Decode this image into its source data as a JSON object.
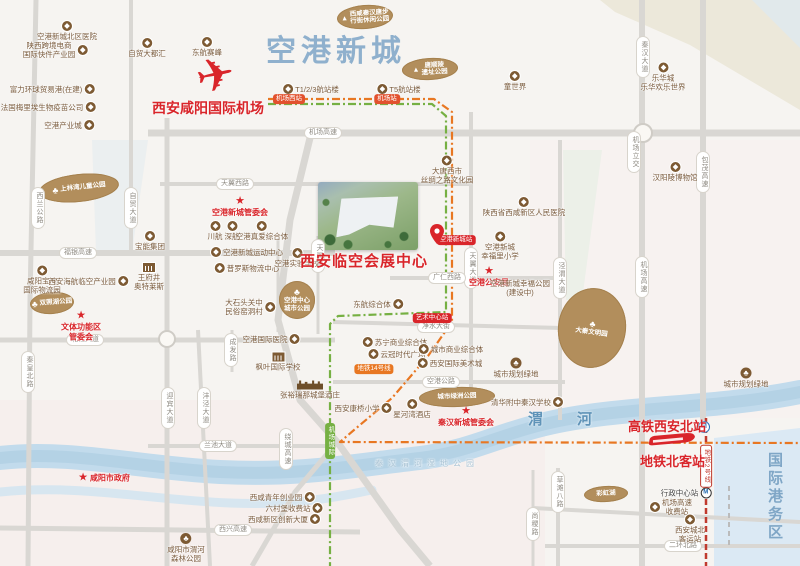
{
  "major": {
    "district": "空港新城",
    "airport": "西安咸阳国际机场",
    "venue": "西安临空会展中心",
    "hsr_station": "高铁西安北站",
    "metro_station": "地铁北客站",
    "river_name": "渭河",
    "port_zone": "国际港务区"
  },
  "colors": {
    "accent_red": "#d9252a",
    "poi_brown": "#7d5a33",
    "blob_brown": "#b28e5c",
    "title_blue": "#8fb0cd",
    "river_blue": "#c2dbec",
    "rail_green": "#76b043",
    "rail_orange": "#e87722",
    "metro_red": "#c03a2e",
    "road_gray": "#d9d7d3"
  },
  "zones": [
    {
      "pts": "600,0 800,0 800,110 690,45 615,12",
      "f": "#ece8da",
      "o": 1
    },
    {
      "pts": "752,0 800,0 800,48",
      "f": "#dde9f2",
      "o": 0.7
    },
    {
      "pts": "530,140 800,140 800,418 530,418",
      "f": "#f8f0ee",
      "o": 0.55
    },
    {
      "pts": "0,400 545,400 545,566 0,566",
      "f": "#f6e9e9",
      "o": 0.5
    },
    {
      "pts": "92,140 148,140 132,252 96,252",
      "f": "#e8eef0",
      "o": 0.8
    },
    {
      "pts": "563,150 602,150 582,300 566,300",
      "f": "#e8efe6",
      "o": 0.8
    },
    {
      "pts": "714,438 800,428 800,566 714,566",
      "f": "#dbe9f4",
      "o": 1
    }
  ],
  "river": [
    {
      "d": "M0,458 C70,450 140,468 220,472 S350,466 420,458 C470,452 495,436 545,424 C620,406 710,410 800,392",
      "c": "#c2dbec",
      "w": 24,
      "o": 1
    },
    {
      "d": "M0,458 C70,450 140,468 220,472 S350,466 420,458 C470,452 495,436 545,424 C620,406 710,410 800,392",
      "c": "#b0d0e4",
      "w": 12,
      "o": 0.8
    },
    {
      "d": "M0,492 C80,484 150,500 230,503 C300,506 340,496 372,490",
      "c": "#cfe3f0",
      "w": 9,
      "o": 0.8
    }
  ],
  "roads": [
    {
      "p": [
        [
          36,
          0
        ],
        [
          30,
          300
        ],
        [
          28,
          566
        ]
      ],
      "w": 5
    },
    {
      "p": [
        [
          131,
          0
        ],
        [
          131,
          253
        ]
      ],
      "w": 4
    },
    {
      "p": [
        [
          167,
          118
        ],
        [
          167,
          566
        ]
      ],
      "w": 5
    },
    {
      "p": [
        [
          198,
          330
        ],
        [
          210,
          566
        ]
      ],
      "w": 4
    },
    {
      "p": [
        [
          232,
          330
        ],
        [
          232,
          372
        ]
      ],
      "w": 3
    },
    {
      "p": [
        [
          278,
          238
        ],
        [
          278,
          332
        ]
      ],
      "w": 3
    },
    {
      "p": [
        [
          318,
          236
        ],
        [
          318,
          334
        ]
      ],
      "w": 3
    },
    {
      "p": [
        [
          471,
          112
        ],
        [
          471,
          390
        ]
      ],
      "w": 4
    },
    {
      "p": [
        [
          560,
          140
        ],
        [
          560,
          420
        ]
      ],
      "w": 4
    },
    {
      "p": [
        [
          558,
          468
        ],
        [
          558,
          566
        ]
      ],
      "w": 4
    },
    {
      "p": [
        [
          642,
          0
        ],
        [
          642,
          566
        ]
      ],
      "w": 6
    },
    {
      "p": [
        [
          703,
          0
        ],
        [
          703,
          425
        ]
      ],
      "w": 6
    },
    {
      "p": [
        [
          533,
          470
        ],
        [
          533,
          566
        ]
      ],
      "w": 3
    },
    {
      "p": [
        [
          148,
          133
        ],
        [
          800,
          133
        ]
      ],
      "w": 7
    },
    {
      "p": [
        [
          160,
          184
        ],
        [
          471,
          184
        ]
      ],
      "w": 4
    },
    {
      "p": [
        [
          0,
          253
        ],
        [
          335,
          253
        ]
      ],
      "w": 6
    },
    {
      "p": [
        [
          390,
          278
        ],
        [
          562,
          278
        ]
      ],
      "w": 4
    },
    {
      "p": [
        [
          333,
          322
        ],
        [
          562,
          328
        ]
      ],
      "w": 4
    },
    {
      "p": [
        [
          0,
          340
        ],
        [
          335,
          340
        ]
      ],
      "w": 5
    },
    {
      "p": [
        [
          333,
          382
        ],
        [
          565,
          382
        ]
      ],
      "w": 4
    },
    {
      "p": [
        [
          148,
          446
        ],
        [
          335,
          446
        ]
      ],
      "w": 4
    },
    {
      "p": [
        [
          0,
          528
        ],
        [
          360,
          532
        ]
      ],
      "w": 5
    },
    {
      "p": [
        [
          545,
          546
        ],
        [
          800,
          546
        ]
      ],
      "w": 4
    },
    {
      "p": [
        [
          533,
          508
        ],
        [
          800,
          522
        ]
      ],
      "w": 4
    },
    {
      "p": [
        [
          310,
          138
        ],
        [
          290,
          220
        ],
        [
          278,
          320
        ],
        [
          300,
          400
        ],
        [
          338,
          443
        ],
        [
          400,
          530
        ],
        [
          430,
          566
        ]
      ],
      "w": 7
    },
    {
      "p": [
        [
          338,
          441
        ],
        [
          295,
          492
        ],
        [
          252,
          566
        ]
      ],
      "w": 5
    }
  ],
  "circles": [
    {
      "x": 167,
      "y": 339,
      "r": 8
    },
    {
      "x": 643,
      "y": 133,
      "r": 9
    }
  ],
  "rails": [
    {
      "p": [
        [
          268,
          104
        ],
        [
          432,
          104
        ],
        [
          446,
          116
        ],
        [
          446,
          312
        ],
        [
          338,
          316
        ],
        [
          330,
          324
        ],
        [
          330,
          566
        ]
      ],
      "c": "#76b043",
      "w": 2.2,
      "d": "8 3 2 3"
    },
    {
      "p": [
        [
          268,
          99
        ],
        [
          434,
          99
        ],
        [
          452,
          112
        ],
        [
          452,
          322
        ],
        [
          428,
          356
        ],
        [
          392,
          398
        ],
        [
          354,
          430
        ],
        [
          340,
          442
        ],
        [
          800,
          443
        ]
      ],
      "c": "#e87722",
      "w": 2.2,
      "d": "8 3 2 3"
    },
    {
      "p": [
        [
          706,
          418
        ],
        [
          706,
          566
        ]
      ],
      "c": "#c03a2e",
      "w": 2.5,
      "d": "6 3"
    },
    {
      "p": [
        [
          729,
          486
        ],
        [
          729,
          546
        ]
      ],
      "c": "#bbbbbb",
      "w": 2,
      "d": "5 4"
    }
  ],
  "blobs": [
    {
      "x": 365,
      "y": 17,
      "rx": 28,
      "ry": 12,
      "rot": -4,
      "kind": "badge",
      "label": "西咸秦汉唐步\n行街休闲公园"
    },
    {
      "x": 430,
      "y": 69,
      "rx": 28,
      "ry": 11,
      "rot": -3,
      "kind": "badge",
      "label": "唐顺陵\n遗址公园"
    },
    {
      "x": 79,
      "y": 188,
      "rx": 40,
      "ry": 14,
      "rot": -6,
      "kind": "tree",
      "label": "上林湾儿童公园"
    },
    {
      "x": 52,
      "y": 303,
      "rx": 22,
      "ry": 11,
      "rot": -4,
      "kind": "tree",
      "label": "双照湖公园"
    },
    {
      "x": 297,
      "y": 300,
      "rx": 18,
      "ry": 19,
      "rot": 0,
      "kind": "treetop",
      "label": "空港中心\n城市公园"
    },
    {
      "x": 592,
      "y": 328,
      "rx": 34,
      "ry": 40,
      "rot": 8,
      "kind": "treetop",
      "label": "大秦文明园"
    },
    {
      "x": 457,
      "y": 397,
      "rx": 38,
      "ry": 10,
      "rot": -2,
      "kind": "plain",
      "label": "城市绿洲公园"
    },
    {
      "x": 606,
      "y": 494,
      "rx": 22,
      "ry": 8,
      "rot": -3,
      "kind": "plain",
      "label": "彩虹湖"
    }
  ],
  "pois": [
    {
      "t": "空港新城北区医院",
      "x": 67,
      "y": 31,
      "i": "c",
      "p": "t"
    },
    {
      "t": "陕西跨境电商\n国际快件产业园",
      "x": 55,
      "y": 50,
      "i": "c",
      "p": "r"
    },
    {
      "t": "自贸大都汇",
      "x": 147,
      "y": 48,
      "i": "c",
      "p": "t"
    },
    {
      "t": "东航赛峰",
      "x": 207,
      "y": 47,
      "i": "c",
      "p": "t"
    },
    {
      "t": "富力环球贸易港(在建)",
      "x": 52,
      "y": 89,
      "i": "c",
      "p": "r"
    },
    {
      "t": "法国梅里埃生物疫苗公司",
      "x": 48,
      "y": 107,
      "i": "c",
      "p": "r"
    },
    {
      "t": "空港产业城",
      "x": 69,
      "y": 125,
      "i": "c",
      "p": "r"
    },
    {
      "t": "T1/2/3航站楼",
      "x": 311,
      "y": 89,
      "i": "c",
      "p": "l"
    },
    {
      "t": "T5航站楼",
      "x": 399,
      "y": 89,
      "i": "c",
      "p": "l"
    },
    {
      "t": "童世界",
      "x": 515,
      "y": 81,
      "i": "c",
      "p": "t"
    },
    {
      "t": "乐华城\n乐华欢乐世界",
      "x": 663,
      "y": 77,
      "i": "c",
      "p": "t"
    },
    {
      "t": "汉阳陵博物馆",
      "x": 675,
      "y": 172,
      "i": "c",
      "p": "t"
    },
    {
      "t": "陕西省西咸新区人民医院",
      "x": 524,
      "y": 207,
      "i": "c",
      "p": "t"
    },
    {
      "t": "大唐西市\n丝绸之路文化园",
      "x": 447,
      "y": 170,
      "i": "c",
      "p": "t"
    },
    {
      "t": "空港新城管委会",
      "x": 240,
      "y": 207,
      "i": "s",
      "p": "t",
      "s": "red"
    },
    {
      "t": "川航",
      "x": 215,
      "y": 231,
      "i": "c",
      "p": "t"
    },
    {
      "t": "深航",
      "x": 232,
      "y": 231,
      "i": "c",
      "p": "t"
    },
    {
      "t": "空港真爱综合体",
      "x": 262,
      "y": 231,
      "i": "c",
      "p": "t"
    },
    {
      "t": "宝能集团",
      "x": 150,
      "y": 241,
      "i": "c",
      "p": "t"
    },
    {
      "t": "空港新城运动中心",
      "x": 247,
      "y": 252,
      "i": "c",
      "p": "l"
    },
    {
      "t": "普罗斯物流中心",
      "x": 247,
      "y": 268,
      "i": "c",
      "p": "l"
    },
    {
      "t": "咸阳宝湾\n国际物流园",
      "x": 42,
      "y": 280,
      "i": "c",
      "p": "t"
    },
    {
      "t": "西安海航临空产业园",
      "x": 88,
      "y": 281,
      "i": "c",
      "p": "r"
    },
    {
      "t": "王府井\n奥特莱斯",
      "x": 149,
      "y": 277,
      "i": "b",
      "p": "t"
    },
    {
      "t": "空港实验学校",
      "x": 297,
      "y": 258,
      "i": "c",
      "p": "t"
    },
    {
      "t": "空港国际医院",
      "x": 271,
      "y": 339,
      "i": "c",
      "p": "r"
    },
    {
      "t": "枫叶国际学校",
      "x": 278,
      "y": 362,
      "i": "b",
      "p": "t"
    },
    {
      "t": "大石头关中\n民俗窑洞村",
      "x": 250,
      "y": 307,
      "i": "c",
      "p": "r"
    },
    {
      "t": "文体功能区\n管委会",
      "x": 81,
      "y": 326,
      "i": "s",
      "p": "t",
      "s": "red"
    },
    {
      "t": "咸阳市政府",
      "x": 104,
      "y": 478,
      "i": "s",
      "p": "l",
      "s": "red"
    },
    {
      "t": "西咸青年创业园",
      "x": 282,
      "y": 497,
      "i": "c",
      "p": "r"
    },
    {
      "t": "六村堡收费站",
      "x": 294,
      "y": 508,
      "i": "c",
      "p": "r"
    },
    {
      "t": "西咸新区创新大厦",
      "x": 284,
      "y": 519,
      "i": "c",
      "p": "r"
    },
    {
      "t": "咸阳市渭河\n森林公园",
      "x": 186,
      "y": 548,
      "i": "t",
      "p": "t"
    },
    {
      "t": "东航综合体",
      "x": 378,
      "y": 304,
      "i": "c",
      "p": "r"
    },
    {
      "t": "苏宁商业综合体",
      "x": 395,
      "y": 342,
      "i": "c",
      "p": "l"
    },
    {
      "t": "云冠时代广场",
      "x": 397,
      "y": 354,
      "i": "c",
      "p": "l"
    },
    {
      "t": "城市商业综合体",
      "x": 451,
      "y": 349,
      "i": "c",
      "p": "l"
    },
    {
      "t": "西安国际美术城",
      "x": 450,
      "y": 363,
      "i": "c",
      "p": "l"
    },
    {
      "t": "张裕瑞那城堡酒庄",
      "x": 310,
      "y": 390,
      "i": "k",
      "p": "t"
    },
    {
      "t": "西安康桥小学",
      "x": 363,
      "y": 408,
      "i": "c",
      "p": "r"
    },
    {
      "t": "星河湾酒店",
      "x": 412,
      "y": 409,
      "i": "c",
      "p": "t"
    },
    {
      "t": "秦汉新城管委会",
      "x": 466,
      "y": 417,
      "i": "s",
      "p": "t",
      "s": "red"
    },
    {
      "t": "清华附中秦汉学校",
      "x": 527,
      "y": 402,
      "i": "c",
      "p": "r"
    },
    {
      "t": "空港新城\n幸福里小学",
      "x": 500,
      "y": 246,
      "i": "c",
      "p": "t"
    },
    {
      "t": "空港公安局",
      "x": 489,
      "y": 277,
      "i": "s",
      "p": "t",
      "s": "red"
    },
    {
      "t": "空港新城幸福公园\n(建设中)",
      "x": 520,
      "y": 288,
      "i": "",
      "p": "n"
    },
    {
      "t": "机场高速\n收费站",
      "x": 671,
      "y": 507,
      "i": "c",
      "p": "l"
    },
    {
      "t": "西安城北\n客运站",
      "x": 690,
      "y": 529,
      "i": "c",
      "p": "t"
    },
    {
      "t": "行政中心站",
      "x": 686,
      "y": 493,
      "i": "m",
      "p": "r",
      "s": "dark"
    },
    {
      "t": "城市规划绿地",
      "x": 516,
      "y": 368,
      "i": "t",
      "p": "t"
    },
    {
      "t": "城市规划绿地",
      "x": 746,
      "y": 378,
      "i": "t",
      "p": "t"
    },
    {
      "t": "秦汉渭河湿地公园",
      "x": 427,
      "y": 464,
      "i": "",
      "p": "n",
      "s": "water"
    }
  ],
  "road_pills": [
    {
      "t": "西兰公路",
      "x": 38,
      "y": 208,
      "v": 1
    },
    {
      "t": "自贸大道",
      "x": 131,
      "y": 208,
      "v": 1
    },
    {
      "t": "秦皇北路",
      "x": 28,
      "y": 372,
      "v": 1
    },
    {
      "t": "迎宾大道",
      "x": 168,
      "y": 408,
      "v": 1
    },
    {
      "t": "沣泾大道",
      "x": 204,
      "y": 408,
      "v": 1
    },
    {
      "t": "成发路",
      "x": 231,
      "y": 350,
      "v": 1
    },
    {
      "t": "天翼路",
      "x": 318,
      "y": 256,
      "v": 1
    },
    {
      "t": "天翼大道",
      "x": 471,
      "y": 268,
      "v": 1
    },
    {
      "t": "泾渭大道",
      "x": 560,
      "y": 278,
      "v": 1
    },
    {
      "t": "机场高速",
      "x": 642,
      "y": 277,
      "v": 1
    },
    {
      "t": "机场立交",
      "x": 634,
      "y": 152,
      "v": 1
    },
    {
      "t": "包茂高速",
      "x": 703,
      "y": 172,
      "v": 1
    },
    {
      "t": "秦汉大道",
      "x": 643,
      "y": 57,
      "v": 1
    },
    {
      "t": "绕城高速",
      "x": 286,
      "y": 449,
      "v": 1
    },
    {
      "t": "草滩八路",
      "x": 558,
      "y": 492,
      "v": 1
    },
    {
      "t": "尚稷路",
      "x": 533,
      "y": 524,
      "v": 1
    },
    {
      "t": "天翼西路",
      "x": 235,
      "y": 184,
      "v": 0
    },
    {
      "t": "机场高速",
      "x": 323,
      "y": 133,
      "v": 0
    },
    {
      "t": "福银高速",
      "x": 78,
      "y": 253,
      "v": 0
    },
    {
      "t": "北杜大道",
      "x": 85,
      "y": 340,
      "v": 0
    },
    {
      "t": "广仁西路",
      "x": 447,
      "y": 278,
      "v": 0
    },
    {
      "t": "净水大街",
      "x": 436,
      "y": 327,
      "v": 0
    },
    {
      "t": "空港公路",
      "x": 441,
      "y": 382,
      "v": 0
    },
    {
      "t": "兰池大道",
      "x": 218,
      "y": 446,
      "v": 0
    },
    {
      "t": "西兴高速",
      "x": 233,
      "y": 530,
      "v": 0
    },
    {
      "t": "二环北路",
      "x": 683,
      "y": 546,
      "v": 0
    }
  ],
  "stations": [
    {
      "t": "机场西站",
      "x": 289,
      "y": 99,
      "bg": "#e2512e",
      "v": 0
    },
    {
      "t": "机场站",
      "x": 387,
      "y": 99,
      "bg": "#e2512e",
      "v": 0
    },
    {
      "t": "空港新城站",
      "x": 456,
      "y": 240,
      "bg": "#d9252a",
      "v": 0
    },
    {
      "t": "艺术中心站",
      "x": 432,
      "y": 318,
      "bg": "#d9252a",
      "v": 0
    },
    {
      "t": "地铁14号线",
      "x": 374,
      "y": 369,
      "bg": "#e87722",
      "v": 0
    },
    {
      "t": "机场城际",
      "x": 330,
      "y": 441,
      "bg": "#76b043",
      "v": 1
    },
    {
      "t": "地铁2号线",
      "x": 706,
      "y": 466,
      "bg": "#c03a2e",
      "v": 1,
      "outline": 1
    }
  ]
}
